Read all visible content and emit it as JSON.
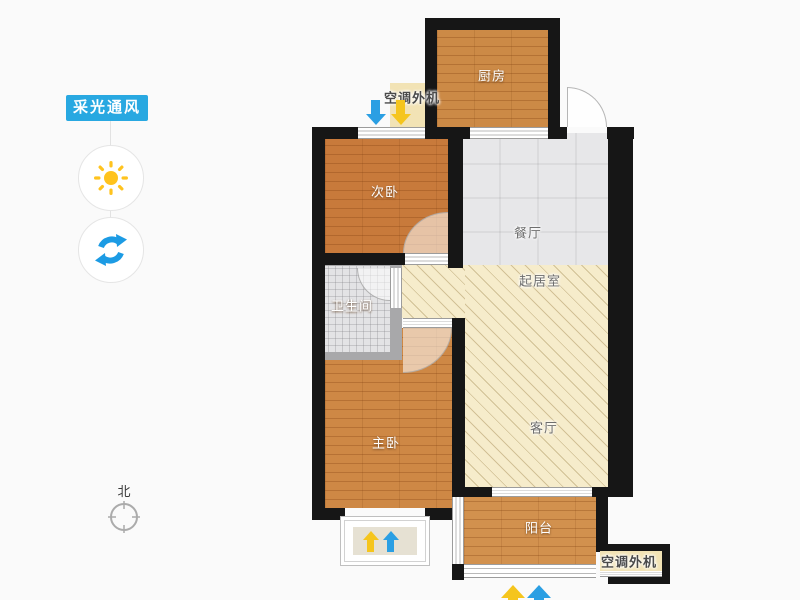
{
  "sidebar": {
    "lighting_button_label": "采光通风",
    "sun_icon": "sun-icon",
    "rotate_icon": "rotate-icon"
  },
  "compass": {
    "north_label": "北"
  },
  "floorplan": {
    "rooms": {
      "kitchen": "厨房",
      "second_bedroom": "次卧",
      "dining_room": "餐厅",
      "living_area": "起居室",
      "bathroom": "卫生间",
      "master_bedroom": "主卧",
      "living_room": "客厅",
      "balcony": "阳台"
    },
    "ac_unit_top": "空调外机",
    "ac_unit_bottom": "空调外机"
  },
  "colors": {
    "accent_blue": "#28A8E1",
    "sun_yellow": "#FFC41F",
    "arrow_blue": "#2B9FE3",
    "arrow_yellow": "#F5C51D",
    "wall_black": "#161616",
    "wood_floor": "#CE8845",
    "hatch_beige": "#F6ECCB",
    "tile_gray": "#E7E7E9"
  }
}
